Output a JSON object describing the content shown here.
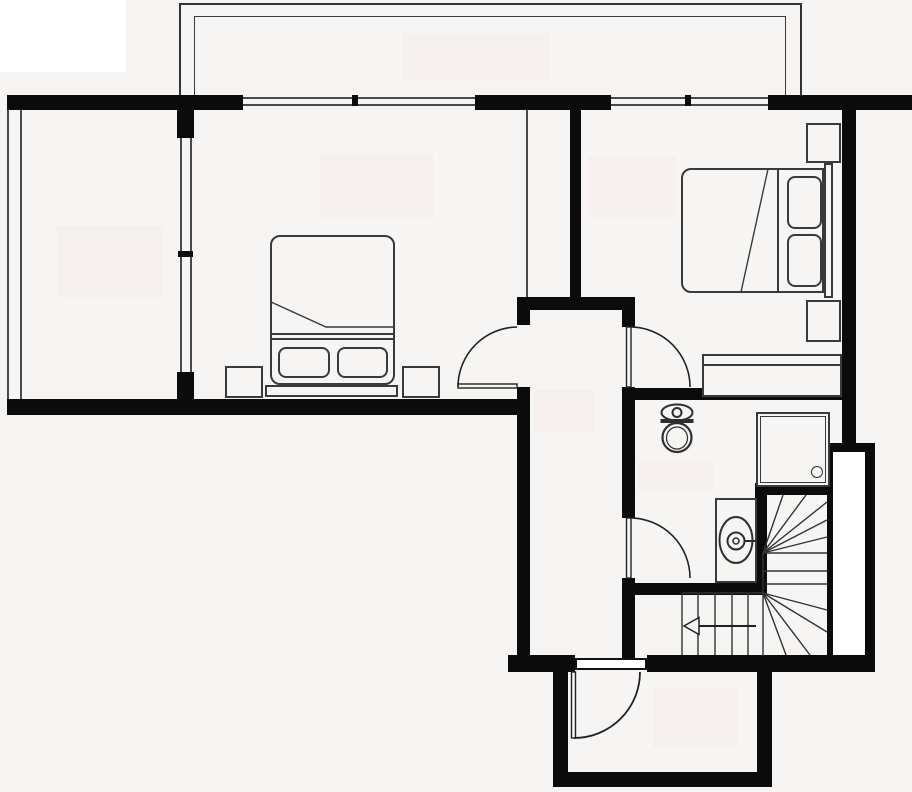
{
  "document": {
    "kind": "architectural floor plan, black-and-white, top-down",
    "visible_text": "none (labels have been blanked out as faint rectangles)",
    "canvas": {
      "width": 912,
      "height": 792
    }
  },
  "colors": {
    "background": "#f6f5f4",
    "wall": "#0b0b0b",
    "furniture_line": "#3a3a3a",
    "thin_wall_line": "#4a4a4a",
    "watermark_patch": "#f5efee",
    "white_patch": "#ffffff",
    "fixture_stroke": "#2e2e2e"
  },
  "rooms": [
    {
      "id": "balcony",
      "name": "Balcony / terrace outline along the top (double railing line)"
    },
    {
      "id": "loggia",
      "name": "Narrow glazed loggia on the far left"
    },
    {
      "id": "bedroom_left",
      "name": "Left bedroom with double bed, two pillows, two nightstands"
    },
    {
      "id": "bedroom_right",
      "name": "Right bedroom with double bed, two pillows, two nightstands, bench"
    },
    {
      "id": "hallway",
      "name": "Central hallway connecting bedrooms, bathroom and entrance"
    },
    {
      "id": "bathroom",
      "name": "Bathroom with toilet, shower cabin and washbasin"
    },
    {
      "id": "staircase",
      "name": "Winder staircase with direction arrow pointing left"
    },
    {
      "id": "porch",
      "name": "Entrance vestibule at the bottom with entry door"
    }
  ],
  "fixtures_furniture": [
    "double-bed-left",
    "pillows-left-x2",
    "nightstands-left-x2",
    "double-bed-right",
    "pillows-right-x2",
    "nightstands-right-x2",
    "bench-right",
    "toilet-with-tank",
    "shower-cabin-with-drain",
    "washbasin-with-faucet",
    "stair-treads-with-winders",
    "stair-direction-arrow"
  ],
  "doors": [
    {
      "room": "bedroom_left",
      "type": "swing",
      "swings_into": "bedroom"
    },
    {
      "room": "bedroom_right",
      "type": "swing",
      "swings_into": "bedroom"
    },
    {
      "room": "bathroom",
      "type": "swing",
      "swings_into": "bathroom"
    },
    {
      "room": "porch",
      "type": "swing",
      "swings_into": "vestibule"
    }
  ],
  "windows": [
    {
      "location": "top wall, left bedroom to balcony",
      "mullions": 1
    },
    {
      "location": "top wall, right bedroom to balcony",
      "mullions": 1
    },
    {
      "location": "glazed partition of loggia",
      "mullions": 1
    }
  ],
  "blank_patches": {
    "white_corner_label": {
      "x": 0,
      "y": 0,
      "w": 126,
      "h": 72
    },
    "watermarks": [
      {
        "room": "balcony",
        "x": 403,
        "y": 33,
        "w": 146,
        "h": 47
      },
      {
        "room": "loggia",
        "x": 57,
        "y": 226,
        "w": 106,
        "h": 71
      },
      {
        "room": "bedroom_left",
        "x": 320,
        "y": 153,
        "w": 113,
        "h": 64
      },
      {
        "room": "bedroom_right",
        "x": 588,
        "y": 157,
        "w": 88,
        "h": 60
      },
      {
        "room": "hallway",
        "x": 535,
        "y": 390,
        "w": 60,
        "h": 42
      },
      {
        "room": "bathroom",
        "x": 638,
        "y": 460,
        "w": 75,
        "h": 32
      },
      {
        "room": "porch",
        "x": 653,
        "y": 688,
        "w": 84,
        "h": 60
      }
    ]
  }
}
